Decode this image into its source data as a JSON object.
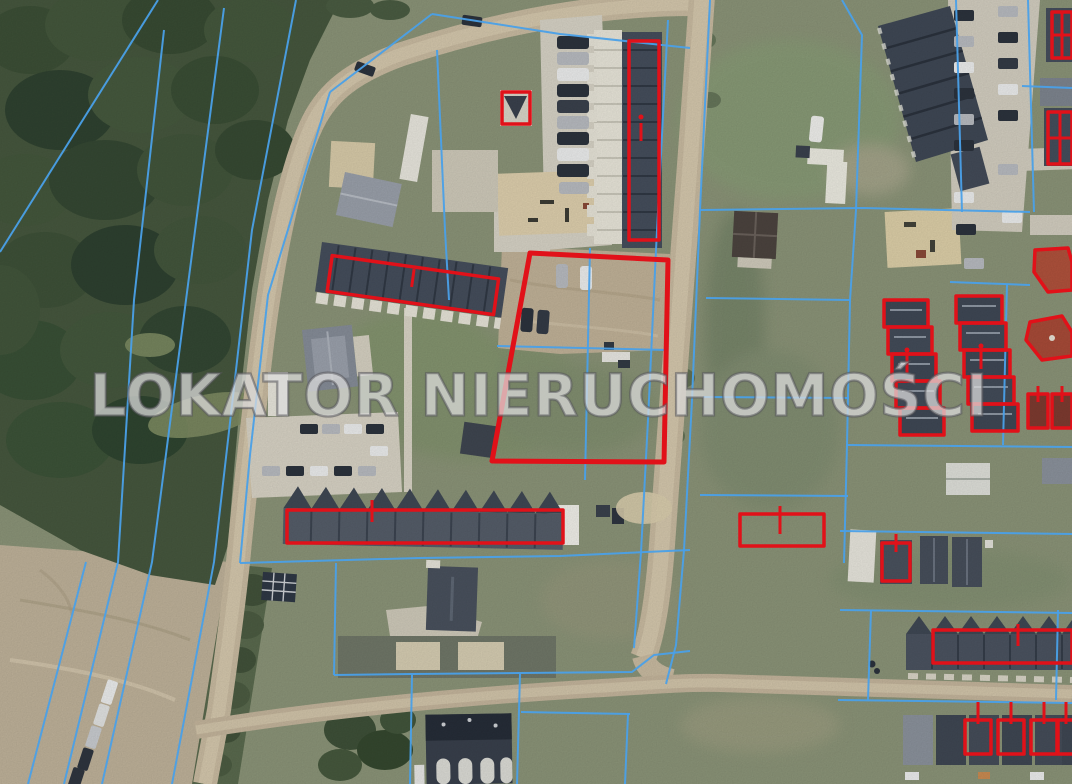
{
  "watermark": {
    "text": "LOKATOR NIERUCHOMOŚCI"
  },
  "map": {
    "type": "satellite-aerial-photo",
    "overlay": {
      "cadastral_boundary_color": "#4aa0e8",
      "highlight_outline_color": "#e11119"
    },
    "highlighted_features": [
      "main-offer-parcel",
      "garage-row-north",
      "garage-row-west",
      "garage-row-southwest",
      "small-cabin-courtyard",
      "vacant-parcel-east",
      "cabin-east",
      "rowhouse-zigzag-west",
      "rowhouse-zigzag-east",
      "long-building-southeast",
      "cabin-row-southeast",
      "buildings-northeast-edge",
      "red-roof-houses-east"
    ]
  },
  "colors": {
    "grass": "#8b9478",
    "forest": "#46573e",
    "dirt": "#c0b094",
    "road": "#c9bba1",
    "pavement": "#d7d3c6",
    "roof-dark": "#454e5c",
    "roof-light": "#e9e6da",
    "boundary": "#4aa0e8",
    "highlight": "#e11119",
    "watermark-fill": "rgba(255,255,255,0.6)",
    "watermark-outline": "rgba(90,90,95,0.55)"
  }
}
